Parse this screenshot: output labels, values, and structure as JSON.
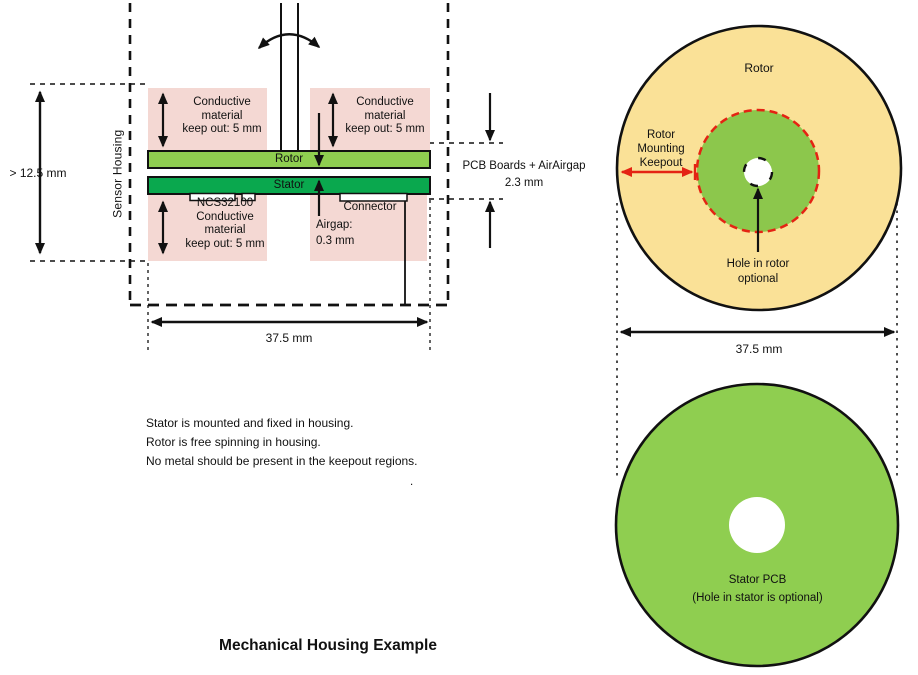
{
  "title": "Mechanical Housing Example",
  "colors": {
    "pink": "#F4D8D3",
    "rotor_green": "#8FCE50",
    "stator_green": "#0AA84E",
    "disc_tan": "#FAE197",
    "keepout_green": "#8CC74C",
    "red": "#E42313",
    "line": "#111111"
  },
  "cross_section": {
    "sensor_housing_label": "Sensor Housing",
    "height_dim": "> 12.5 mm",
    "width_dim": "37.5 mm",
    "keepout_top_left": "Conductive\nmaterial\nkeep out: 5 mm",
    "keepout_top_right": "Conductive\nmaterial\nkeep out: 5 mm",
    "keepout_bottom_left": "NCS32100\nConductive\nmaterial\nkeep out: 5 mm",
    "rotor_label": "Rotor",
    "stator_label": "Stator",
    "connector_label": "Connector",
    "airgap_label": "Airgap:\n0.3 mm",
    "pcb_stack_label": "PCB Boards + AirAirgap\n2.3 mm"
  },
  "notes": "Stator is mounted and fixed in housing.\nRotor is free spinning in housing.\nNo metal should be present in the keepout regions.",
  "stray_dot": ".",
  "rotor_view": {
    "rotor_label": "Rotor",
    "mounting_keepout_label": "Rotor\nMounting\nKeepout",
    "hole_label": "Hole in rotor\noptional",
    "width_dim": "37.5 mm"
  },
  "stator_view": {
    "label": "Stator PCB\n(Hole in stator is optional)"
  }
}
